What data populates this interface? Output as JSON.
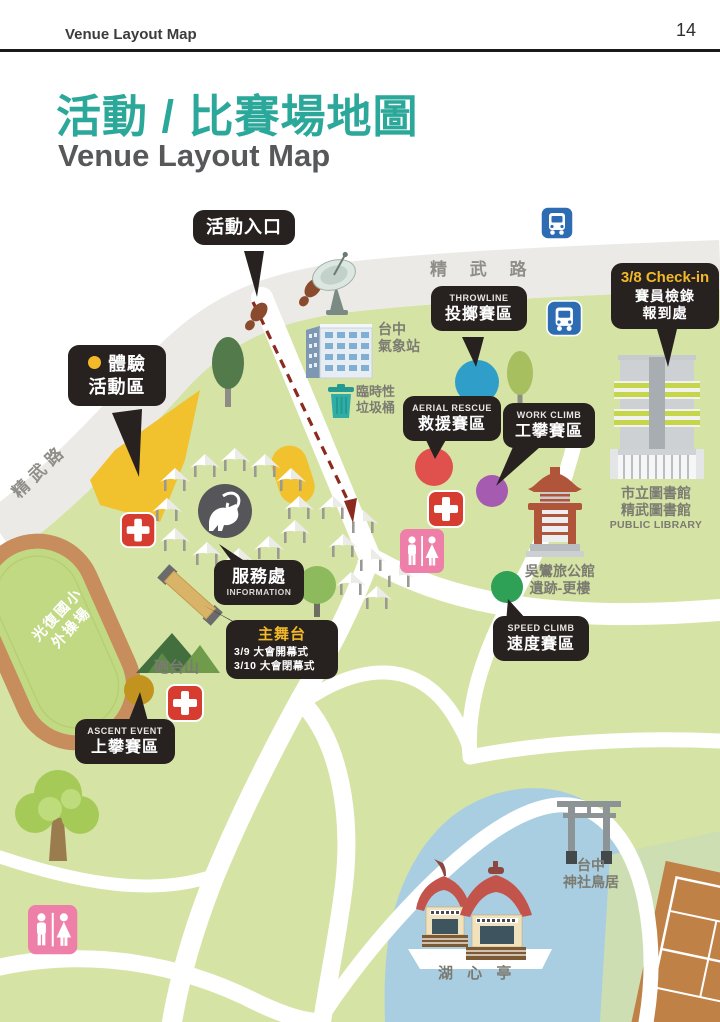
{
  "header": {
    "doc_label": "Venue Layout Map",
    "page_number": "14"
  },
  "title": {
    "zh": "活動 / 比賽場地圖",
    "en": "Venue Layout Map"
  },
  "roads": {
    "jingwu_top": "精 武 路",
    "jingwu_left": "精武路"
  },
  "bubbles": {
    "entrance": {
      "label": "活動入口"
    },
    "experience": {
      "line1": "體驗",
      "line2": "活動區"
    },
    "throwline": {
      "en": "THROWLINE",
      "zh": "投擲賽區"
    },
    "checkin": {
      "line1": "3/8 Check-in",
      "line2": "賽員檢錄",
      "line3": "報到處"
    },
    "aerial_rescue": {
      "en": "AERIAL RESCUE",
      "zh": "救援賽區"
    },
    "work_climb": {
      "en": "WORK CLIMB",
      "zh": "工攀賽區"
    },
    "information": {
      "zh": "服務處",
      "en": "INFORMATION"
    },
    "main_stage": {
      "title": "主舞台",
      "schedule1": "3/9   大會開幕式",
      "schedule2": "3/10 大會閉幕式"
    },
    "speed_climb": {
      "en": "SPEED CLIMB",
      "zh": "速度賽區"
    },
    "ascent_event": {
      "en": "ASCENT EVENT",
      "zh": "上攀賽區"
    }
  },
  "labels": {
    "weather_station": {
      "line1": "台中",
      "line2": "氣象站"
    },
    "trash": {
      "line1": "臨時性",
      "line2": "垃圾桶"
    },
    "wu_mansion": {
      "line1": "吳鸞旅公館",
      "line2": "遺跡-更樓"
    },
    "library": {
      "line1": "市立圖書館",
      "line2": "精武圖書館",
      "line3": "PUBLIC LIBRARY"
    },
    "cannon_hill": "砲台山",
    "torii": {
      "line1": "台中",
      "line2": "神社鳥居"
    },
    "pavilion": "湖 心 亭",
    "track": {
      "line1": "光復國小",
      "line2": "外操場"
    }
  },
  "colors": {
    "accent_teal": "#2BA89A",
    "bubble_black": "#272120",
    "highlight_yellow": "#F2B929",
    "map_green": "#D5E3A5",
    "lake_blue": "#A9CEE2",
    "zone_blue": "#2F9FCA",
    "zone_red": "#E0514D",
    "zone_purple": "#A55CB0",
    "zone_green": "#2EA156",
    "zone_gold": "#C3931F"
  }
}
